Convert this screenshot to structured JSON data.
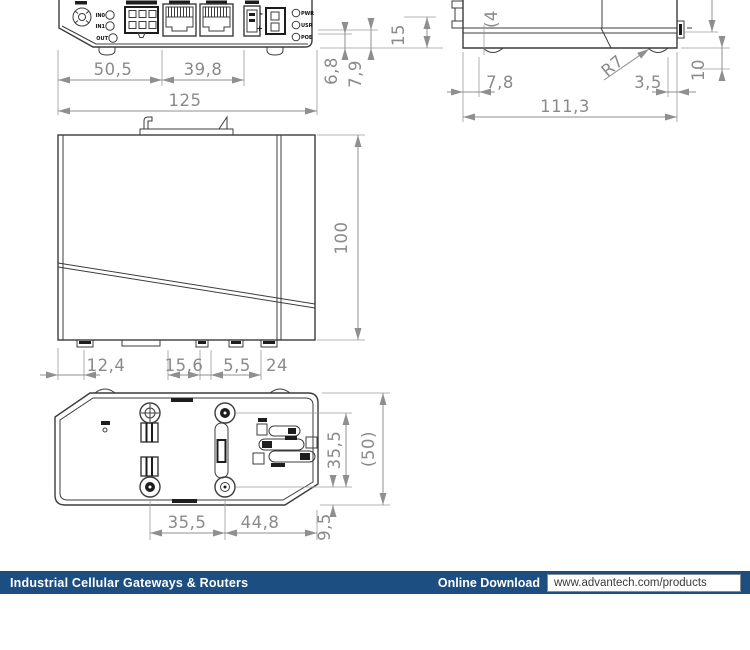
{
  "drawing": {
    "front_view": {
      "dim_50_5": "50,5",
      "dim_39_8": "39,8",
      "dim_125": "125",
      "dim_6_8": "6,8",
      "dim_7_9": "7,9",
      "dim_15": "15",
      "label_in0": "IN0",
      "label_in1": "IN1",
      "label_out": "OUT",
      "label_pwr": "PWR",
      "label_usr": "USR",
      "label_poe": "POE",
      "mark_minus": "-",
      "mark_plus": "+"
    },
    "side_view": {
      "dim_7_8": "7,8",
      "dim_3_5": "3,5",
      "dim_111_3": "111,3",
      "dim_10": "10",
      "dim_r7": "R7",
      "dim_partial": "(4"
    },
    "face_view": {
      "dim_100": "100",
      "dim_12_4": "12,4",
      "dim_15_6": "15,6",
      "dim_5_5": "5,5",
      "dim_24": "24"
    },
    "bottom_view": {
      "dim_35_5_v": "35,5",
      "dim_50_paren": "(50)",
      "dim_35_5_h": "35,5",
      "dim_44_8": "44,8",
      "dim_9_5": "9,5"
    }
  },
  "footer": {
    "title": "Industrial Cellular Gateways & Routers",
    "download_label": "Online Download",
    "url": "www.advantech.com/products"
  }
}
